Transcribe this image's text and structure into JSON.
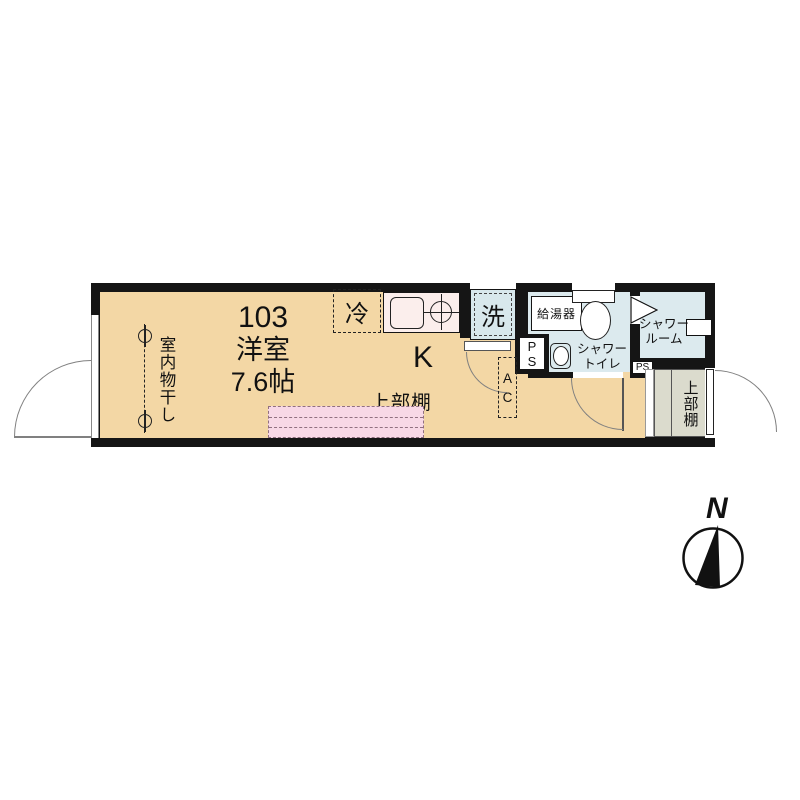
{
  "unit": {
    "number": "103",
    "room_type": "洋室",
    "size": "7.6帖"
  },
  "main_room": {
    "indoor_drying": "室内物干し",
    "upper_shelf": "上部棚",
    "kitchen": "K",
    "fridge": "冷",
    "ac_letters": [
      "A",
      "C"
    ]
  },
  "wet_area": {
    "washer": "洗",
    "water_heater": "給湯器",
    "shower_toilet": [
      "シャワー",
      "トイレ"
    ],
    "pipe_space_letters": [
      "P",
      "S"
    ],
    "pipe_space_small": "PS",
    "shower_room": [
      "シャワー",
      "ルーム"
    ]
  },
  "entrance": {
    "upper_shelf": "上部棚"
  },
  "compass": {
    "north": "N"
  },
  "colors": {
    "floor_tan": "#F3D7A5",
    "wet_area_blue": "#DCEAEE",
    "counter_pink": "#FBEEEC",
    "shelf_pink": "#F8D8E6",
    "entrance_gray": "#DBDBCD",
    "wall_black": "#151515"
  }
}
